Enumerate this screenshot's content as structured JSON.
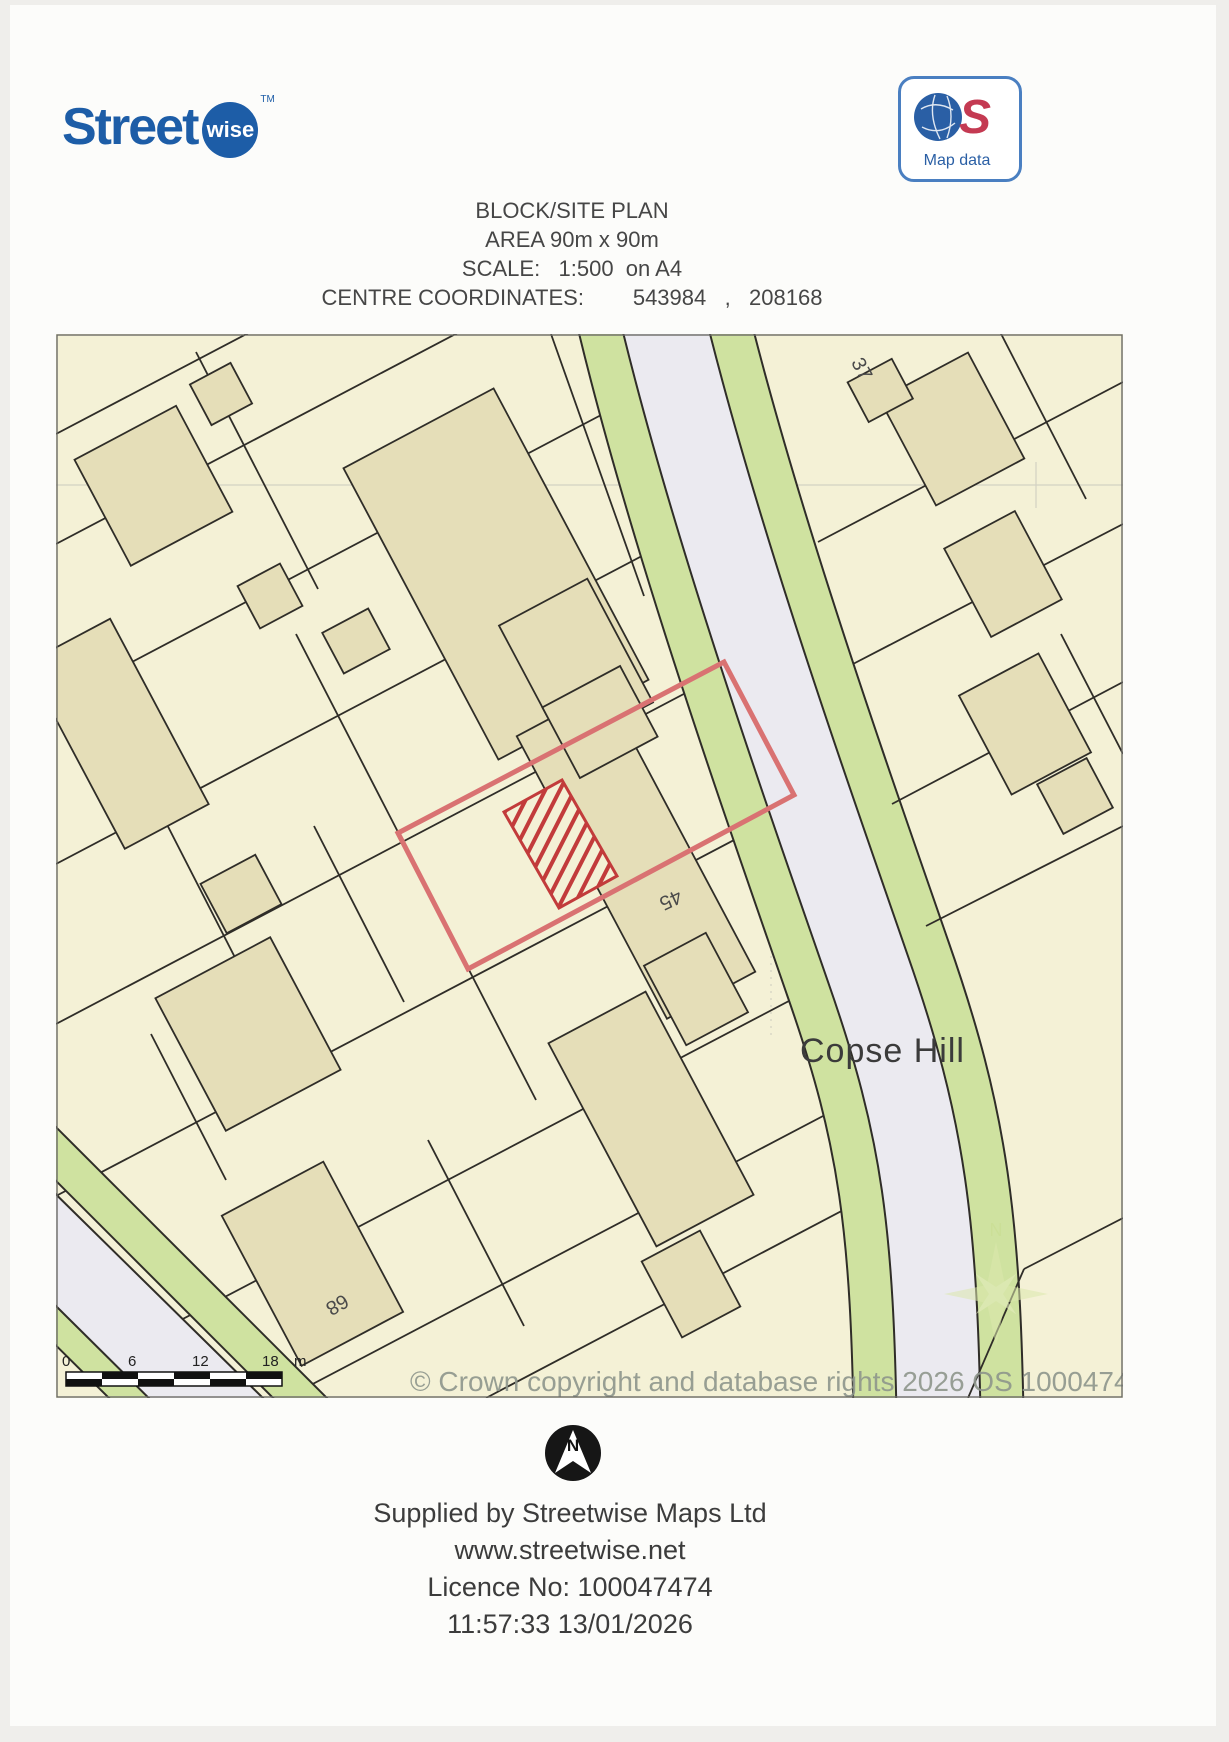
{
  "logo": {
    "brand": "Street",
    "badge": "wise",
    "tm": "TM"
  },
  "os_badge": {
    "s_letter": "S",
    "label": "Map data"
  },
  "header": {
    "line1": "BLOCK/SITE PLAN",
    "line2": "AREA 90m x 90m",
    "line3": "SCALE:   1:500  on A4",
    "line4": "CENTRE COORDINATES:        543984   ,   208168"
  },
  "map": {
    "labels": {
      "street": "Copse Hill",
      "plot_number_right": "37",
      "plot_number_centre": "45",
      "plot_number_bottom": "68"
    },
    "watermark": "© Crown copyright and database rights 2026 OS 100047474",
    "scale_bar": {
      "t0": "0",
      "t6": "6",
      "t12": "12",
      "t18": "18",
      "unit": "m"
    },
    "colors": {
      "parcel": "#f4f1d6",
      "building": "#e5deb8",
      "road": "#ebeaf0",
      "verge": "#cfe2a0",
      "plot_outline": "#d97272",
      "hatch": "#c23b3b",
      "line": "#2f2d28"
    }
  },
  "compass": {
    "letter": "N"
  },
  "footer": {
    "line1": "Supplied by Streetwise Maps Ltd",
    "line2": "www.streetwise.net",
    "line3": "Licence No: 100047474",
    "line4": "11:57:33 13/01/2026"
  }
}
